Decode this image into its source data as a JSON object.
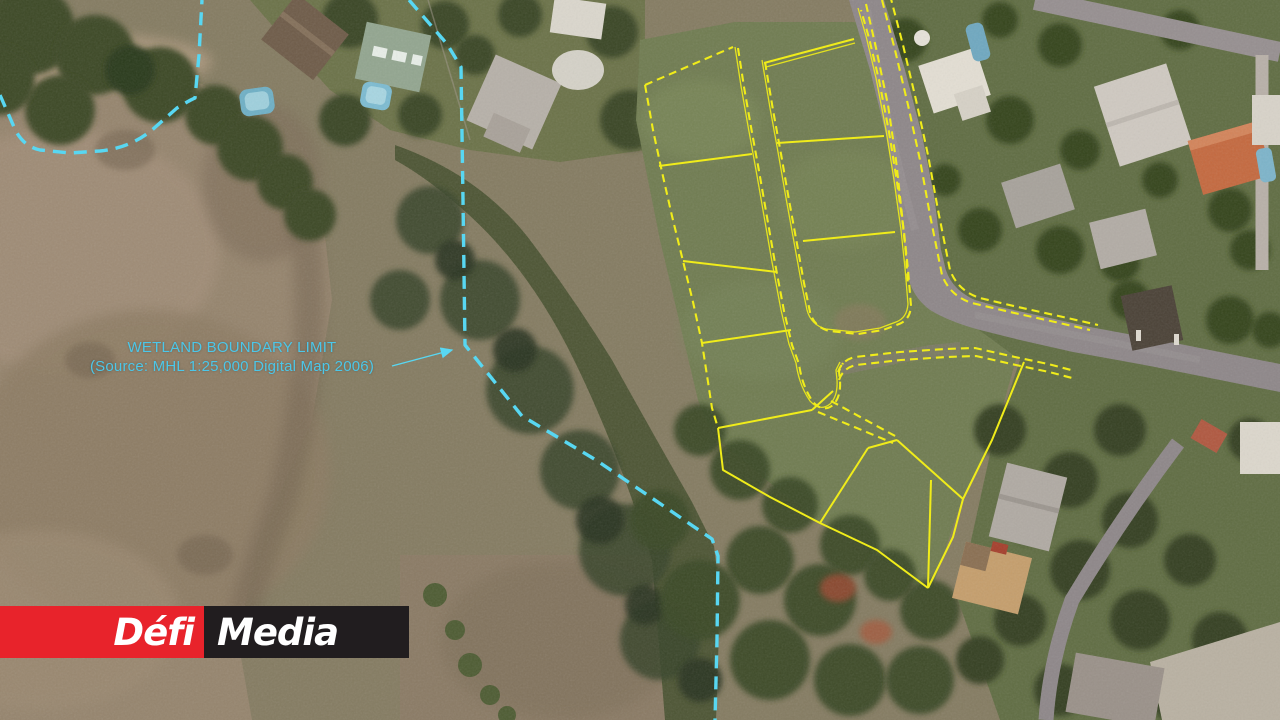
{
  "annotation": {
    "title": "WETLAND BOUNDARY LIMIT",
    "source": "(Source: MHL 1:25,000 Digital Map 2006)"
  },
  "logo": {
    "primary": "Défi",
    "secondary": "Media"
  },
  "map_legend": {
    "cyan_dashed_line": "wetland boundary limit",
    "yellow_lines": "parcel subdivision boundaries",
    "yellow_dashed_lines": "road reserve edges"
  },
  "colors": {
    "wetland_line": "#58d7f2",
    "annotation_text": "#4cc7e9",
    "parcel_line": "#f0ec1a",
    "road_gray": "#8e8789",
    "logo_red": "#e8232b",
    "logo_dark": "#211d1f",
    "logo_text": "#ffffff"
  }
}
